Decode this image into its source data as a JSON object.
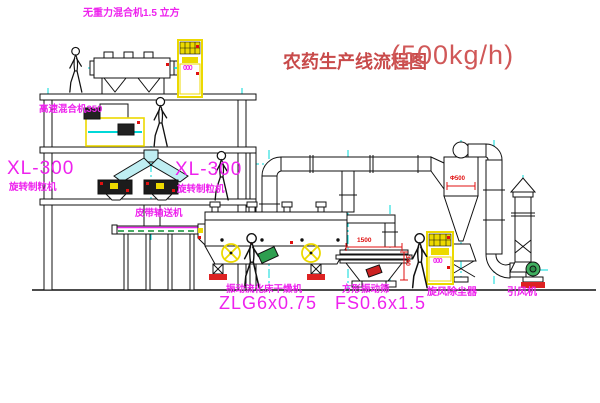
{
  "title": {
    "name": "农药生产线流程图",
    "capacity": "(500kg/h)"
  },
  "equipment": {
    "top_mixer": {
      "label": "无重力混合机1.5 立方"
    },
    "floor2_mixer": {
      "label": "高速混合机350"
    },
    "granulator_left": {
      "model": "XL-300",
      "name": "旋转制粒机"
    },
    "granulator_right": {
      "model": "XL-300",
      "name": "旋转制粒机"
    },
    "belt_conveyor": {
      "label": "皮带输送机"
    },
    "dryer": {
      "name": "振动流化床干燥机",
      "model": "ZLG6x0.75"
    },
    "screen": {
      "name": "方形振动筛",
      "model": "FS0.6x1.5",
      "dim_width": "1500",
      "dim_height": "340"
    },
    "cyclone": {
      "label": "旋风除尘器",
      "dim": "Φ500"
    },
    "fan": {
      "label": "引风机"
    },
    "cabinet_top": {
      "display": "000"
    },
    "cabinet_right": {
      "display": "000"
    }
  },
  "colors": {
    "label_magenta": "#ee22ee",
    "title_red": "#c84a4a",
    "line_black": "#111111",
    "centerline_cyan": "#00d8d8",
    "equipment_yellow": "#ecd900",
    "accent_red": "#e01010",
    "accent_green": "#2e9e4f"
  }
}
